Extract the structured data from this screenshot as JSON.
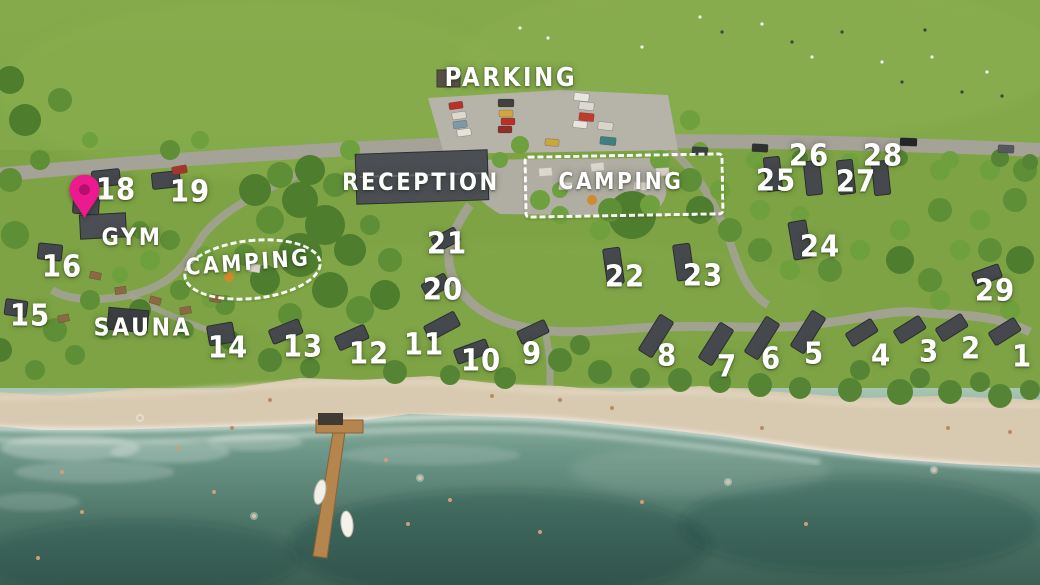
{
  "map": {
    "labels": {
      "parking": "Parking",
      "reception": "Reception",
      "camping_right": "Camping",
      "camping_left": "Camping",
      "gym": "Gym",
      "sauna": "Sauna"
    },
    "cabins": [
      {
        "label": "1"
      },
      {
        "label": "2"
      },
      {
        "label": "3"
      },
      {
        "label": "4"
      },
      {
        "label": "5"
      },
      {
        "label": "6"
      },
      {
        "label": "7"
      },
      {
        "label": "8"
      },
      {
        "label": "9"
      },
      {
        "label": "10"
      },
      {
        "label": "11"
      },
      {
        "label": "12"
      },
      {
        "label": "13"
      },
      {
        "label": "14"
      },
      {
        "label": "15"
      },
      {
        "label": "16"
      },
      {
        "label": "18"
      },
      {
        "label": "19"
      },
      {
        "label": "20"
      },
      {
        "label": "21"
      },
      {
        "label": "22"
      },
      {
        "label": "23"
      },
      {
        "label": "24"
      },
      {
        "label": "25"
      },
      {
        "label": "26"
      },
      {
        "label": "27"
      },
      {
        "label": "28"
      },
      {
        "label": "29"
      }
    ],
    "colors": {
      "pin": "#ec1a8e",
      "pin_hole": "#b30f6d",
      "label_text": "#ffffff",
      "camping_outline": "#ffffff",
      "grass": "#7fa945",
      "road": "#a9a69b",
      "sand": "#d8cab1",
      "water_shallow": "#a9c6b4",
      "water_deep": "#3c5f54",
      "cabin_roof": "#45494d"
    }
  }
}
